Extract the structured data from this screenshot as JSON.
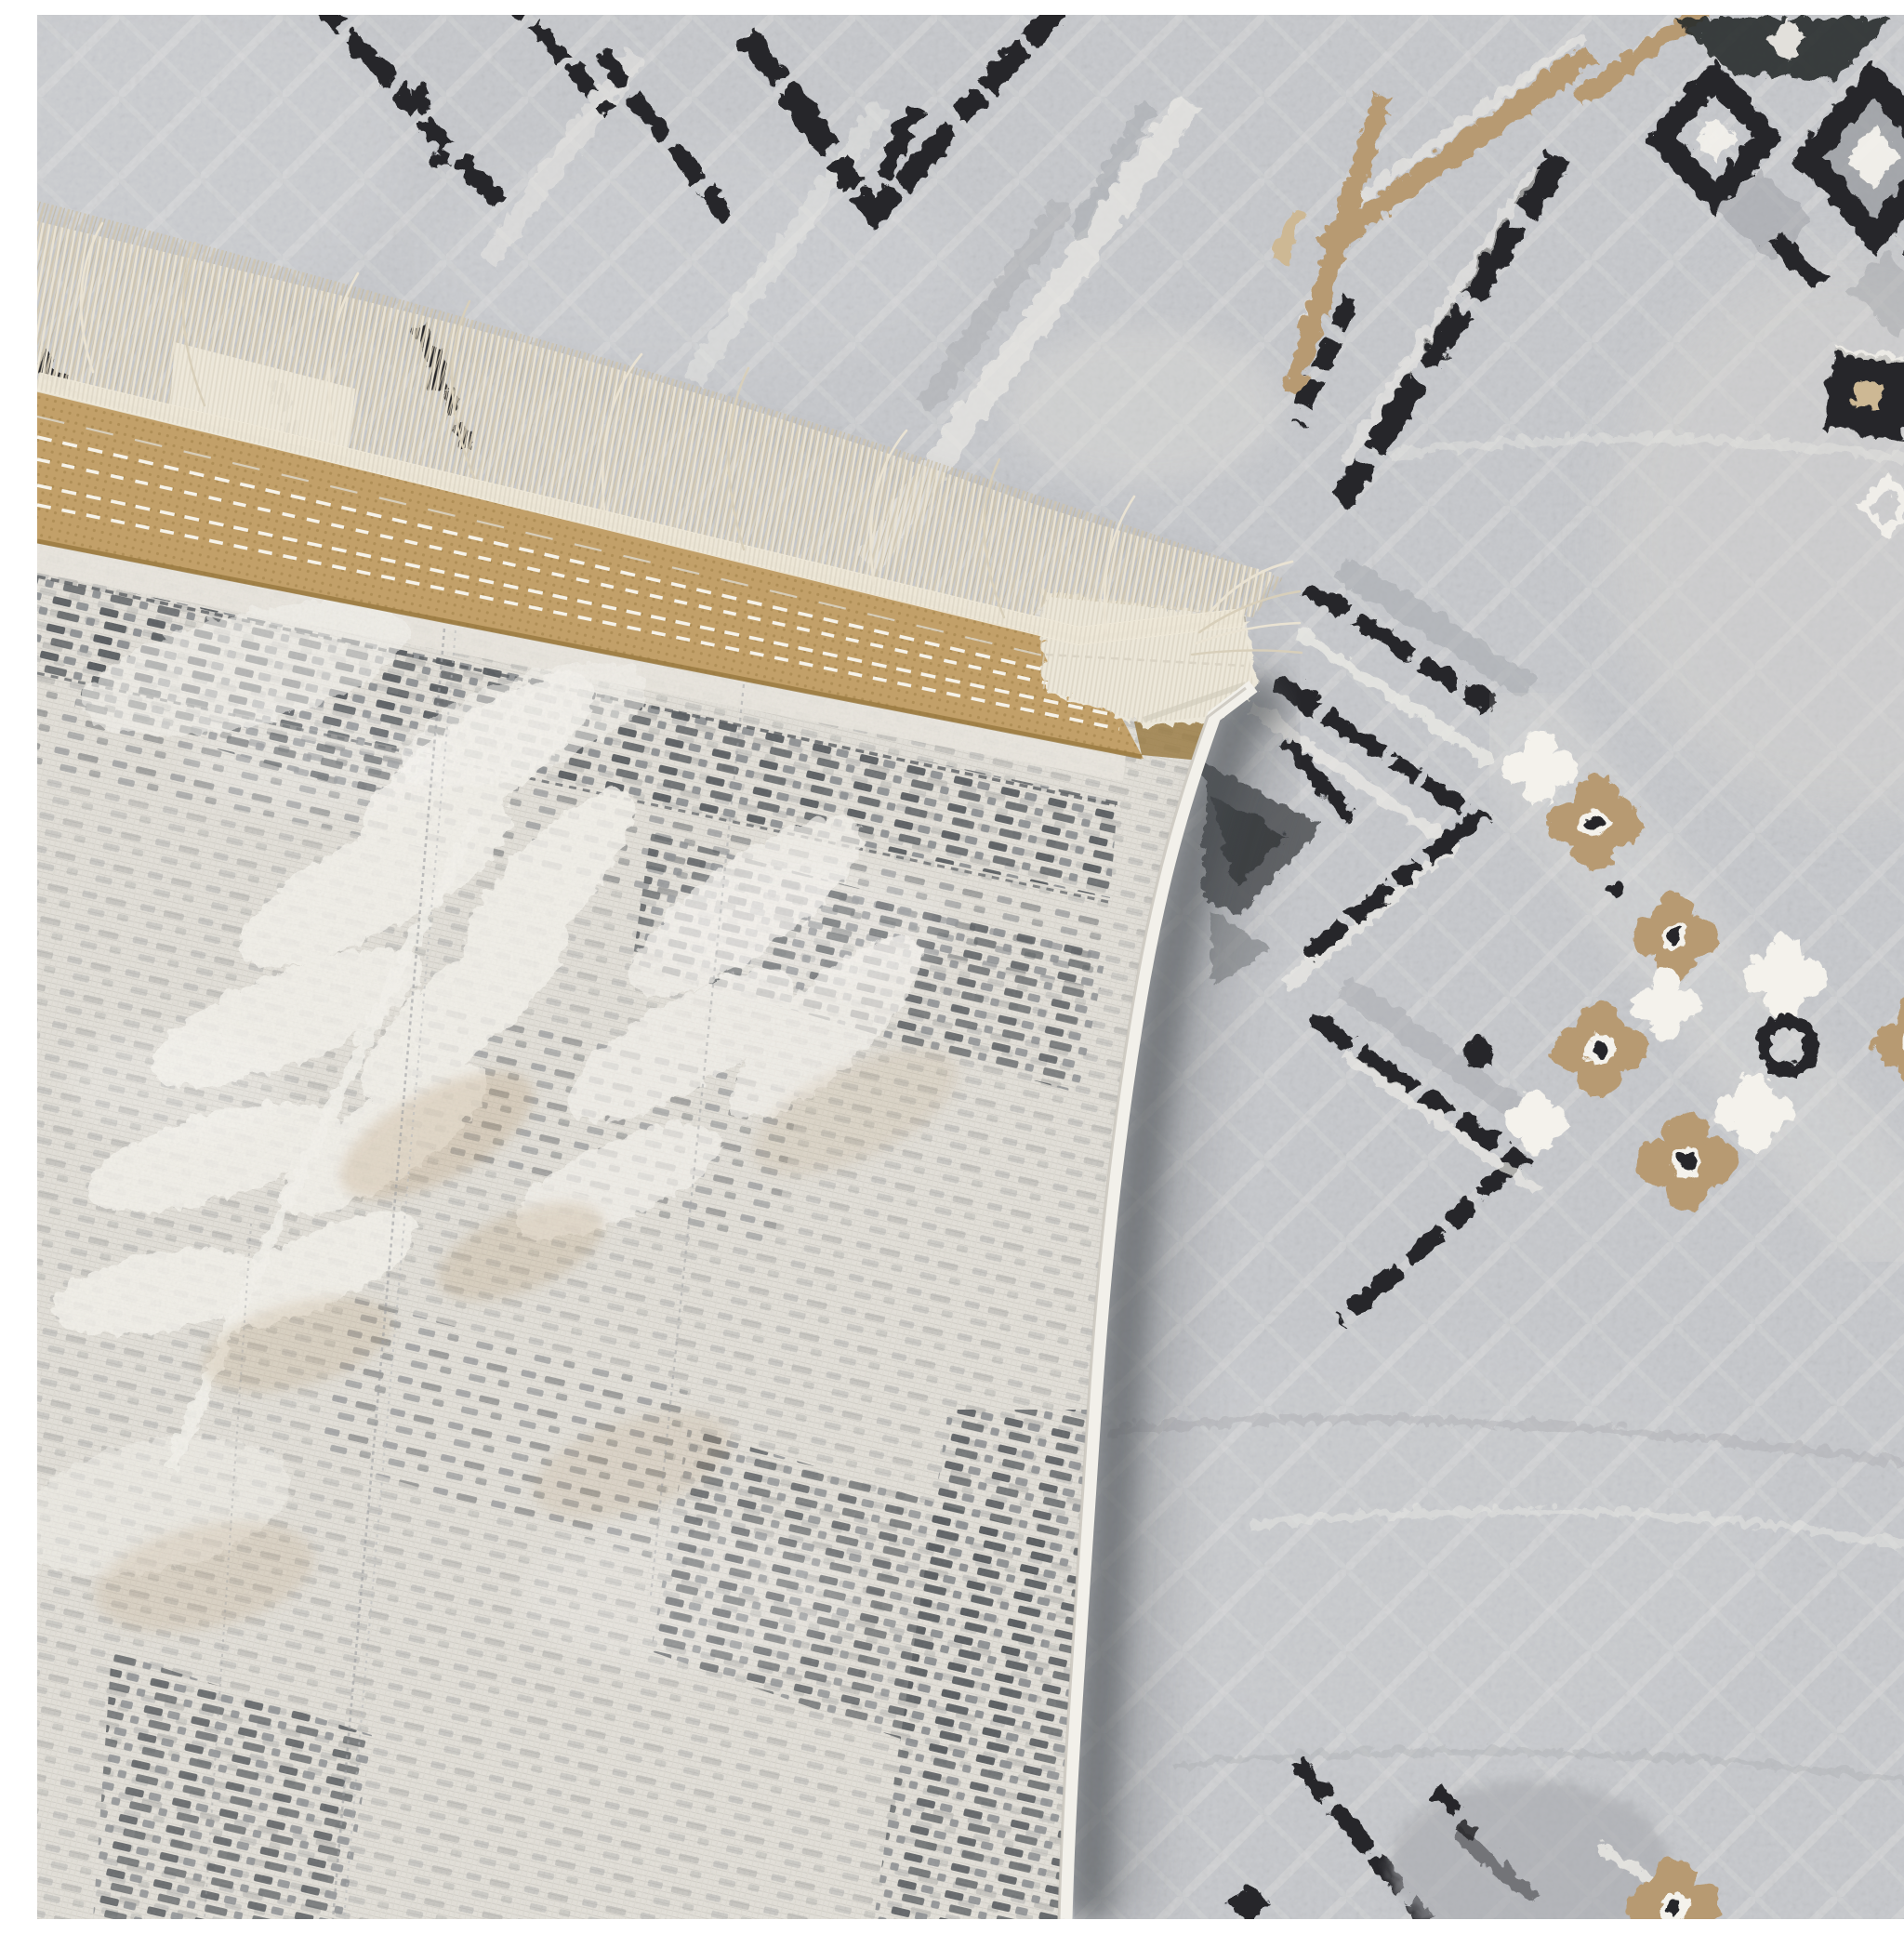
{
  "meta": {
    "title": "Close-up photograph of a machine-woven area rug with its corner folded over",
    "description": "The gray front pile of the rug shows black dashed diagonal lines, tan diagonal stripes, a black diamond lattice, right-pointing black chevron motifs and beige four-petal flowers with black dots. The folded corner reveals the rug's woven back with gray dashed rows and pale palm-leaf shapes, a tan anti-slip binding strip with four white stitch lines, a cream fringe of fine threads, a white overcast corner webbing and a white serged selvedge edge casting a shadow on the pile below."
  },
  "scene": {
    "front_rug": {
      "label": "rug front pile (gray, geometric pattern)",
      "motifs": [
        "black dashed diagonal lines upper-left",
        "black zigzag apex top-center",
        "tan diagonal stripes top-right",
        "black diamond lattice with white squares top-right corner",
        "small black square with beige center, right side",
        "small white diamond outline, right side",
        "black right-pointing chevron zigzag center-right",
        "beige four-petal flowers with white centers and black dots",
        "white flower clusters",
        "dark gray triangle near fold edge",
        "black dashes and faint motifs bottom-right",
        "tone-on-tone cream lattice texture"
      ]
    },
    "folded_back": {
      "label": "rug back (woven underside), corner folded over front",
      "features": [
        "cream weave with rows of gray dashes",
        "dense dashed border band parallel to edge",
        "pale palm-leaf motif mirrored in weave",
        "thin warp seam lines",
        "beige tinted patches"
      ]
    },
    "edge_finish": {
      "fringe": "cream thread fringe along folded edge",
      "binding": "tan anti-slip binding tape with dotted texture",
      "stitching": "four white dashed stitch lines along binding",
      "corner": "white overcast webbing wrapping the corner",
      "selvedge": "white serged edge running down the fold side",
      "shadow": "soft shadow cast by fold onto pile"
    }
  },
  "palette": {
    "front-base": "#c6c8cc",
    "front-light": "#e9e8e4",
    "front-shade": "#a9abb0",
    "motif-black": "#26282b",
    "motif-beige": "#b79a72",
    "motif-beige-light": "#cdb894",
    "back-base": "#e3e0d9",
    "back-dash-dark": "#565a5e",
    "back-dash-mid": "#8d9093",
    "back-white": "#f4f2ec",
    "binding-tan": "#c2a069",
    "binding-tan-dark": "#97783f",
    "stitch-white": "#f6f3ea",
    "fringe-cream": "#eae3d3",
    "fringe-dark": "#cfc5ae",
    "webbing-cream": "#ece7d9",
    "selvedge-white": "#f2f0ea",
    "shadow-dark": "#45484d"
  }
}
